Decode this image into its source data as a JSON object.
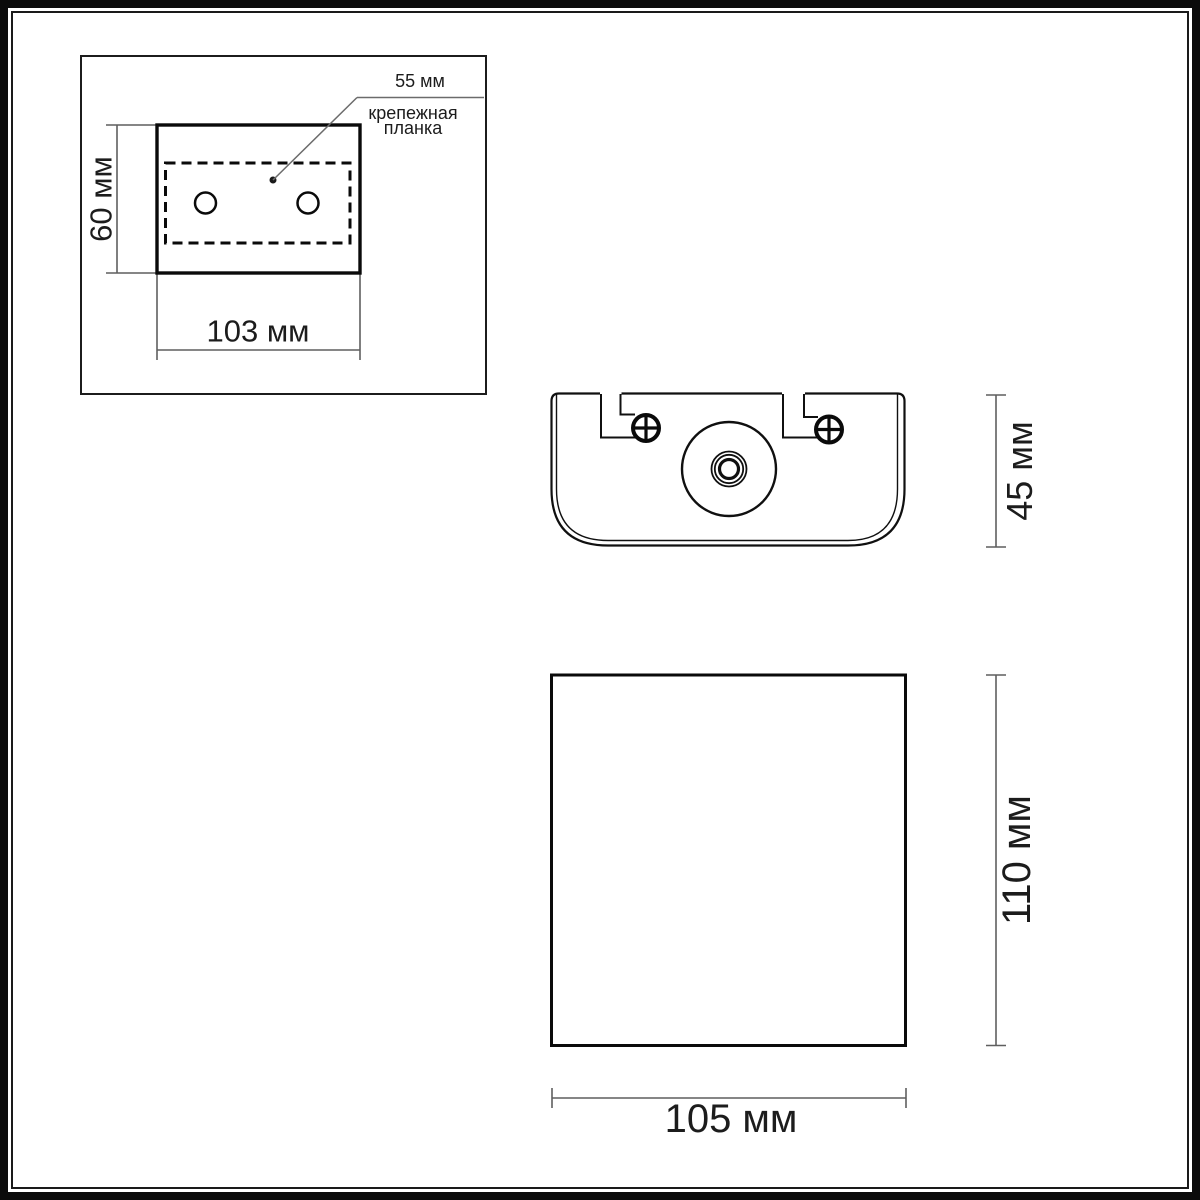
{
  "drawing": {
    "backplate_view": {
      "height_label": "60 мм",
      "width_label": "103 мм",
      "callout": {
        "value": "55 мм",
        "name_line1": "крепежная",
        "name_line2": "планка"
      }
    },
    "side_view": {
      "height_label": "45 мм"
    },
    "front_view": {
      "height_label": "110 мм",
      "width_label": "105 мм"
    },
    "colors": {
      "ink": "#111111",
      "dim_line": "#5f5f5f",
      "background": "#ffffff"
    }
  }
}
